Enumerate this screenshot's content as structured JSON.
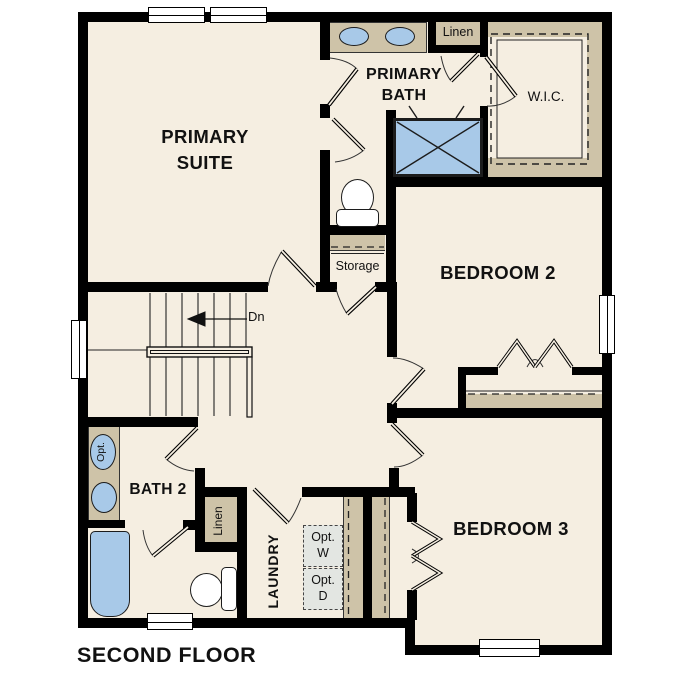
{
  "title": "SECOND FLOOR",
  "rooms": {
    "primary_suite": "PRIMARY\nSUITE",
    "primary_bath": "PRIMARY\nBATH",
    "wic": "W.I.C.",
    "bedroom2": "BEDROOM 2",
    "bedroom3": "BEDROOM 3",
    "bath2": "BATH 2",
    "laundry": "LAUNDRY",
    "storage": "Storage"
  },
  "closets": {
    "linen_top": "Linen",
    "linen_bottom": "Linen"
  },
  "stairs": {
    "down_label": "Dn"
  },
  "options": {
    "washer": "Opt.\nW",
    "dryer": "Opt.\nD",
    "sink": "Opt."
  },
  "colors": {
    "floor": "#f5eee1",
    "wall": "#000000",
    "casework_tan": "#cec3a8",
    "fixture_blue": "#a8c9e8",
    "optional_gray": "#e3e6e2"
  }
}
